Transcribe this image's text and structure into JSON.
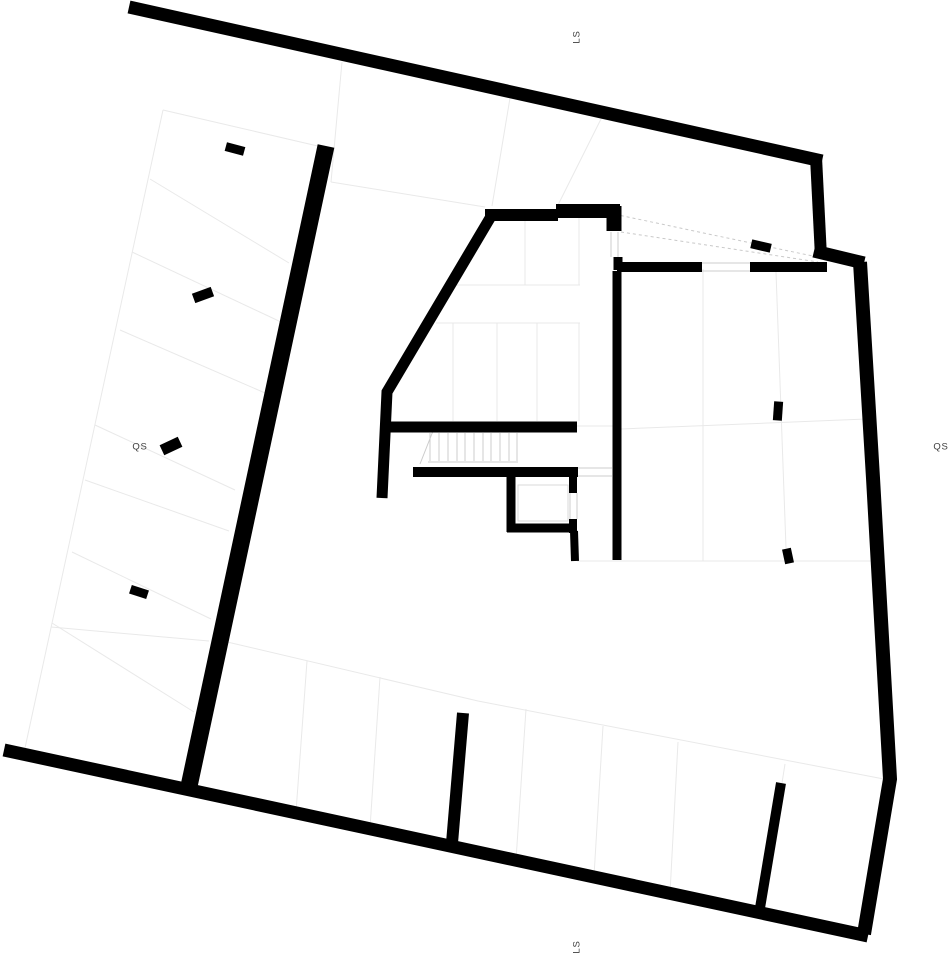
{
  "page": {
    "title": "Architectural site plan with section markers"
  },
  "colors": {
    "background": "#ffffff",
    "wall": "#000000",
    "faint_line": "#e9e9e9",
    "detail_line": "#cccccc",
    "dashed_line": "#c9c9c9",
    "box_line": "#d9d9d9",
    "label": "#3c3c3c"
  },
  "plan": {
    "width": 952,
    "height": 957,
    "walls": [
      {
        "name": "boundary-north",
        "w": 13,
        "pts": [
          [
            129,
            7
          ],
          [
            822,
            161
          ]
        ]
      },
      {
        "name": "boundary-step-east",
        "w": 12,
        "pts": [
          [
            816,
            157
          ],
          [
            821,
            257
          ]
        ]
      },
      {
        "name": "boundary-step-south",
        "w": 13,
        "pts": [
          [
            814,
            251
          ],
          [
            864,
            263
          ]
        ]
      },
      {
        "name": "boundary-east",
        "w": 14,
        "pts": [
          [
            860,
            262
          ],
          [
            873,
            478
          ],
          [
            890,
            779
          ],
          [
            864,
            934
          ]
        ]
      },
      {
        "name": "boundary-south",
        "w": 13,
        "pts": [
          [
            4,
            750
          ],
          [
            868,
            936
          ]
        ]
      },
      {
        "name": "garage-spine-wall",
        "w": 17,
        "pts": [
          [
            326,
            146
          ],
          [
            188,
            791
          ]
        ]
      },
      {
        "name": "building-top-wall-a",
        "w": 12,
        "pts": [
          [
            485,
            215
          ],
          [
            558,
            215
          ]
        ]
      },
      {
        "name": "building-top-wall-b",
        "w": 14,
        "pts": [
          [
            556,
            211
          ],
          [
            620,
            211
          ]
        ]
      },
      {
        "name": "building-ne-corner",
        "w": 15,
        "pts": [
          [
            614,
            206
          ],
          [
            614,
            231
          ]
        ]
      },
      {
        "name": "east-wall-jamb",
        "w": 9,
        "pts": [
          [
            618,
            257
          ],
          [
            618,
            270
          ]
        ]
      },
      {
        "name": "east-wall-a",
        "w": 10,
        "pts": [
          [
            617,
            267
          ],
          [
            702,
            267
          ]
        ]
      },
      {
        "name": "east-wall-b",
        "w": 10,
        "pts": [
          [
            750,
            267
          ],
          [
            827,
            267
          ]
        ]
      },
      {
        "name": "central-vertical-wall",
        "w": 9,
        "pts": [
          [
            617,
            271
          ],
          [
            617,
            560
          ]
        ]
      },
      {
        "name": "west-diagonal-wall",
        "w": 11,
        "pts": [
          [
            493,
            213
          ],
          [
            387,
            392
          ],
          [
            382,
            498
          ]
        ]
      },
      {
        "name": "mid-horizontal-wall",
        "w": 11,
        "pts": [
          [
            384,
            427
          ],
          [
            577,
            427
          ]
        ]
      },
      {
        "name": "stair-hall-wall",
        "w": 10,
        "pts": [
          [
            413,
            472
          ],
          [
            578,
            472
          ]
        ]
      },
      {
        "name": "elevator-wall-left",
        "w": 9,
        "pts": [
          [
            511,
            476
          ],
          [
            511,
            532
          ]
        ]
      },
      {
        "name": "elevator-wall-bottom",
        "w": 9,
        "pts": [
          [
            507,
            528
          ],
          [
            576,
            528
          ]
        ]
      },
      {
        "name": "elevator-wall-right-a",
        "w": 8,
        "pts": [
          [
            573,
            477
          ],
          [
            573,
            493
          ]
        ]
      },
      {
        "name": "elevator-wall-right-b",
        "w": 8,
        "pts": [
          [
            573,
            519
          ],
          [
            573,
            533
          ]
        ]
      },
      {
        "name": "below-elevator-wall",
        "w": 8,
        "pts": [
          [
            574,
            531
          ],
          [
            575,
            561
          ]
        ]
      },
      {
        "name": "parking-wall-a",
        "w": 12,
        "pts": [
          [
            463,
            713
          ],
          [
            452,
            843
          ]
        ]
      },
      {
        "name": "parking-wall-b",
        "w": 10,
        "pts": [
          [
            781,
            783
          ],
          [
            760,
            908
          ]
        ]
      }
    ],
    "faint_lines": [
      {
        "name": "boundary-west-line",
        "pts": [
          [
            163,
            110
          ],
          [
            25,
            748
          ]
        ]
      },
      {
        "name": "stall-line-1",
        "pts": [
          [
            163,
            110
          ],
          [
            322,
            147
          ]
        ]
      },
      {
        "name": "stall-line-2",
        "pts": [
          [
            150,
            179
          ],
          [
            289,
            263
          ]
        ]
      },
      {
        "name": "stall-line-3",
        "pts": [
          [
            132,
            252
          ],
          [
            281,
            322
          ]
        ]
      },
      {
        "name": "stall-line-4",
        "pts": [
          [
            120,
            330
          ],
          [
            272,
            396
          ]
        ]
      },
      {
        "name": "stall-line-5",
        "pts": [
          [
            95,
            425
          ],
          [
            235,
            490
          ]
        ]
      },
      {
        "name": "stall-line-6",
        "pts": [
          [
            85,
            480
          ],
          [
            229,
            531
          ]
        ]
      },
      {
        "name": "stall-line-7",
        "pts": [
          [
            72,
            552
          ],
          [
            211,
            619
          ]
        ]
      },
      {
        "name": "stall-line-8",
        "pts": [
          [
            52,
            623
          ],
          [
            194,
            712
          ]
        ]
      },
      {
        "name": "stall-line-9",
        "pts": [
          [
            51,
            627
          ],
          [
            209,
            641
          ]
        ]
      },
      {
        "name": "parking-front-line",
        "pts": [
          [
            223,
            641
          ],
          [
            478,
            701
          ],
          [
            889,
            780
          ]
        ]
      },
      {
        "name": "parking-divider-1",
        "pts": [
          [
            307,
            661
          ],
          [
            296,
            812
          ]
        ]
      },
      {
        "name": "parking-divider-2",
        "pts": [
          [
            380,
            677
          ],
          [
            370,
            828
          ]
        ]
      },
      {
        "name": "parking-divider-3",
        "pts": [
          [
            526,
            709
          ],
          [
            516,
            860
          ]
        ]
      },
      {
        "name": "parking-divider-4",
        "pts": [
          [
            603,
            726
          ],
          [
            594,
            876
          ]
        ]
      },
      {
        "name": "parking-divider-5",
        "pts": [
          [
            678,
            742
          ],
          [
            670,
            893
          ]
        ]
      },
      {
        "name": "parking-divider-6",
        "pts": [
          [
            785,
            764
          ],
          [
            782,
            783
          ]
        ]
      },
      {
        "name": "courtyard-line-a",
        "pts": [
          [
            342,
            62
          ],
          [
            331,
            182
          ]
        ]
      },
      {
        "name": "courtyard-line-b",
        "pts": [
          [
            331,
            182
          ],
          [
            485,
            207
          ]
        ]
      },
      {
        "name": "courtyard-line-c",
        "pts": [
          [
            510,
            98
          ],
          [
            492,
            206
          ]
        ]
      },
      {
        "name": "courtyard-line-d",
        "pts": [
          [
            602,
            117
          ],
          [
            558,
            205
          ]
        ]
      },
      {
        "name": "room-partition-1",
        "pts": [
          [
            525,
            221
          ],
          [
            525,
            285
          ]
        ]
      },
      {
        "name": "room-partition-2",
        "pts": [
          [
            579,
            218
          ],
          [
            579,
            285
          ]
        ]
      },
      {
        "name": "room-partition-3",
        "pts": [
          [
            455,
            285
          ],
          [
            580,
            285
          ]
        ]
      },
      {
        "name": "room-partition-4",
        "pts": [
          [
            436,
            323
          ],
          [
            580,
            323
          ]
        ]
      },
      {
        "name": "room-partition-5",
        "pts": [
          [
            453,
            323
          ],
          [
            453,
            421
          ]
        ]
      },
      {
        "name": "room-partition-6",
        "pts": [
          [
            497,
            323
          ],
          [
            497,
            421
          ]
        ]
      },
      {
        "name": "room-partition-7",
        "pts": [
          [
            537,
            323
          ],
          [
            537,
            421
          ]
        ]
      },
      {
        "name": "room-partition-8",
        "pts": [
          [
            579,
            323
          ],
          [
            579,
            421
          ]
        ]
      },
      {
        "name": "room-partition-9",
        "pts": [
          [
            577,
            426
          ],
          [
            613,
            426
          ]
        ]
      },
      {
        "name": "east-room-line-1",
        "pts": [
          [
            621,
            429
          ],
          [
            866,
            419
          ]
        ]
      },
      {
        "name": "east-room-line-2",
        "pts": [
          [
            703,
            269
          ],
          [
            703,
            561
          ]
        ]
      },
      {
        "name": "east-room-line-3",
        "pts": [
          [
            776,
            272
          ],
          [
            786,
            548
          ]
        ]
      },
      {
        "name": "east-room-line-4",
        "pts": [
          [
            577,
            561
          ],
          [
            872,
            561
          ]
        ]
      }
    ],
    "detail_lines": [
      {
        "name": "stair-tread",
        "pts": [
          [
            430,
            433
          ],
          [
            430,
            461
          ]
        ]
      },
      {
        "name": "stair-tread",
        "pts": [
          [
            439,
            433
          ],
          [
            439,
            461
          ]
        ]
      },
      {
        "name": "stair-tread",
        "pts": [
          [
            448,
            433
          ],
          [
            448,
            461
          ]
        ]
      },
      {
        "name": "stair-tread",
        "pts": [
          [
            457,
            433
          ],
          [
            457,
            461
          ]
        ]
      },
      {
        "name": "stair-tread",
        "pts": [
          [
            465,
            433
          ],
          [
            465,
            461
          ]
        ]
      },
      {
        "name": "stair-tread",
        "pts": [
          [
            474,
            433
          ],
          [
            474,
            461
          ]
        ]
      },
      {
        "name": "stair-tread",
        "pts": [
          [
            483,
            433
          ],
          [
            483,
            461
          ]
        ]
      },
      {
        "name": "stair-tread",
        "pts": [
          [
            491,
            433
          ],
          [
            491,
            461
          ]
        ]
      },
      {
        "name": "stair-tread",
        "pts": [
          [
            500,
            433
          ],
          [
            500,
            461
          ]
        ]
      },
      {
        "name": "stair-tread",
        "pts": [
          [
            509,
            433
          ],
          [
            509,
            461
          ]
        ]
      },
      {
        "name": "stair-tread",
        "pts": [
          [
            517,
            433
          ],
          [
            517,
            461
          ]
        ]
      },
      {
        "name": "stair-bottom-edge",
        "pts": [
          [
            428,
            462
          ],
          [
            518,
            462
          ]
        ]
      },
      {
        "name": "stair-break-line",
        "pts": [
          [
            420,
            464
          ],
          [
            433,
            431
          ]
        ]
      },
      {
        "name": "door-jamb",
        "pts": [
          [
            611,
            232
          ],
          [
            611,
            257
          ]
        ]
      },
      {
        "name": "door-jamb",
        "pts": [
          [
            618,
            232
          ],
          [
            618,
            257
          ]
        ]
      },
      {
        "name": "opening-edge",
        "pts": [
          [
            702,
            263
          ],
          [
            750,
            263
          ]
        ]
      },
      {
        "name": "opening-edge",
        "pts": [
          [
            702,
            271
          ],
          [
            750,
            271
          ]
        ]
      },
      {
        "name": "opening-edge",
        "pts": [
          [
            578,
            468
          ],
          [
            612,
            468
          ]
        ]
      },
      {
        "name": "opening-edge",
        "pts": [
          [
            578,
            476
          ],
          [
            612,
            476
          ]
        ]
      },
      {
        "name": "elevator-door-jamb",
        "pts": [
          [
            570,
            493
          ],
          [
            570,
            519
          ]
        ]
      },
      {
        "name": "elevator-door-jamb",
        "pts": [
          [
            577,
            493
          ],
          [
            577,
            519
          ]
        ]
      }
    ],
    "dashed_lines": [
      {
        "name": "ramp-edge-a",
        "pts": [
          [
            609,
            213
          ],
          [
            822,
            258
          ]
        ]
      },
      {
        "name": "ramp-edge-b",
        "pts": [
          [
            621,
            232
          ],
          [
            818,
            262
          ]
        ]
      }
    ],
    "boxes": [
      {
        "name": "elevator-cab",
        "x": 518,
        "y": 485,
        "w": 50,
        "h": 36
      }
    ],
    "columns": [
      {
        "name": "column-marker",
        "cx": 235,
        "cy": 149,
        "w": 19,
        "h": 9,
        "rot": 15
      },
      {
        "name": "column-marker",
        "cx": 203,
        "cy": 295,
        "w": 20,
        "h": 10,
        "rot": -20
      },
      {
        "name": "column-marker",
        "cx": 171,
        "cy": 446,
        "w": 20,
        "h": 11,
        "rot": -25
      },
      {
        "name": "column-marker",
        "cx": 139,
        "cy": 592,
        "w": 18,
        "h": 9,
        "rot": 18
      },
      {
        "name": "column-marker",
        "cx": 761,
        "cy": 246,
        "w": 20,
        "h": 9,
        "rot": 13
      },
      {
        "name": "column-marker",
        "cx": 778,
        "cy": 411,
        "w": 9,
        "h": 19,
        "rot": 4
      },
      {
        "name": "column-marker",
        "cx": 788,
        "cy": 556,
        "w": 9,
        "h": 15,
        "rot": -12
      }
    ],
    "labels": [
      {
        "id": "ls-north",
        "text": "LS",
        "x": 577,
        "y": 37,
        "rot": -90,
        "size": 9.5
      },
      {
        "id": "qs-west",
        "text": "QS",
        "x": 140,
        "y": 447,
        "rot": 0,
        "size": 9.5
      },
      {
        "id": "qs-east",
        "text": "QS",
        "x": 941,
        "y": 447,
        "rot": 0,
        "size": 9.5
      },
      {
        "id": "ls-south",
        "text": "LS",
        "x": 577,
        "y": 947,
        "rot": -90,
        "size": 9.5
      }
    ]
  }
}
